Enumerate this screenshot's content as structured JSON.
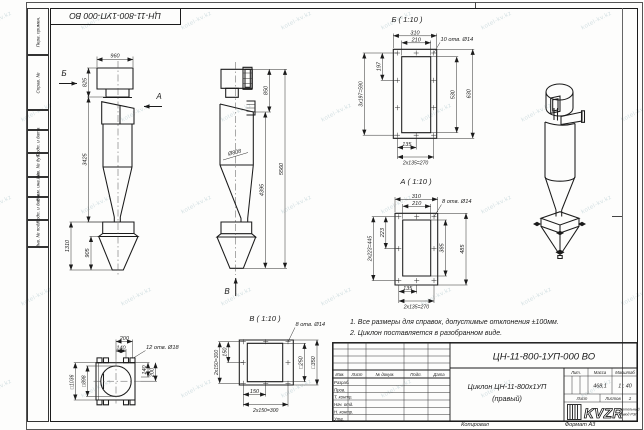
{
  "sheet": {
    "doc_number_top": "ЦН-11-800-1УП-000 ВО",
    "copied_label": "Копировал",
    "format_label": "Формат А3",
    "watermark_text": "kotel-kv.kz",
    "side_labels": {
      "perv": "Перв. примен.",
      "sprav": "Справ. №",
      "podp1": "Подп. и дата",
      "inv_dubl": "Инв. № дубл.",
      "vzam": "Взам. инв. №",
      "podp2": "Подп. и дата",
      "inv_podl": "Инв. № подл."
    }
  },
  "notes": {
    "line1": "1. Все размеры для справок, допустимые отклонения ±100мм.",
    "line2": "2. Циклон поставляется в разобранном виде."
  },
  "views": {
    "front": {
      "dim_width": "960",
      "dim_h1": "825",
      "dim_h2": "3425",
      "dim_h3": "1310",
      "dim_h4": "905",
      "arrow_b": "Б",
      "arrow_a": "А"
    },
    "side": {
      "dim_dia": "Ø808",
      "dim_h1": "850",
      "dim_h2": "4395",
      "dim_h3": "5560",
      "arrow_v": "В"
    },
    "flange_b": {
      "title": "Б ( 1:10 )",
      "holes": "10 отв. Ø14",
      "w_out": "310",
      "w_in": "210",
      "pitch_v": "197",
      "pitch_v_total": "3х197=590",
      "h_in": "530",
      "h_out": "630",
      "pitch_b": "135",
      "pitch_b_total": "2х135=270"
    },
    "flange_a": {
      "title": "А ( 1:10 )",
      "holes": "8 отв. Ø14",
      "w_out": "310",
      "w_in": "210",
      "pitch_v": "223",
      "pitch_v_total": "2х223=445",
      "h_in": "385",
      "h_out": "485",
      "pitch_b": "135",
      "pitch_b_total": "2х135=270"
    },
    "flange_v": {
      "title": "В ( 1:10 )",
      "holes": "8 отв. Ø14",
      "pitch_l": "150",
      "pitch_l_total": "2х150=300",
      "sq_in": "□250",
      "sq_out": "□350",
      "pitch_b": "150",
      "pitch_b_total": "2х150=300"
    },
    "support": {
      "dim_200t": "200",
      "dim_140t": "140",
      "holes": "12 отв. Ø18",
      "dim_140r": "140",
      "dim_200r": "200",
      "sq_out": "□1036",
      "sq_in": "□898"
    }
  },
  "title_block": {
    "doc_number": "ЦН-11-800-1УП-000 ВО",
    "name_line1": "Циклон ЦН-11-800х1УП",
    "name_line2": "(правый)",
    "lit_label": "Лит.",
    "mass_label": "Масса",
    "scale_label": "Масштаб",
    "mass_value": "468,1",
    "scale_value": "1 : 40",
    "sheet_label": "Лист",
    "sheets_label": "Листов",
    "sheets_value": "1",
    "cols": {
      "izm": "Изм.",
      "list": "Лист",
      "doc": "№ докум.",
      "podp": "Подп.",
      "data": "Дата"
    },
    "rows": {
      "razrab": "Разраб.",
      "prov": "Пров.",
      "tkontr": "Т. контр.",
      "nachotd": "Нач. отд.",
      "nkontr": "Н. контр.",
      "utv": "Утв."
    },
    "logo_text": "KVZR",
    "logo_sub1": "Котельный",
    "logo_sub2": "завод РЭП"
  }
}
